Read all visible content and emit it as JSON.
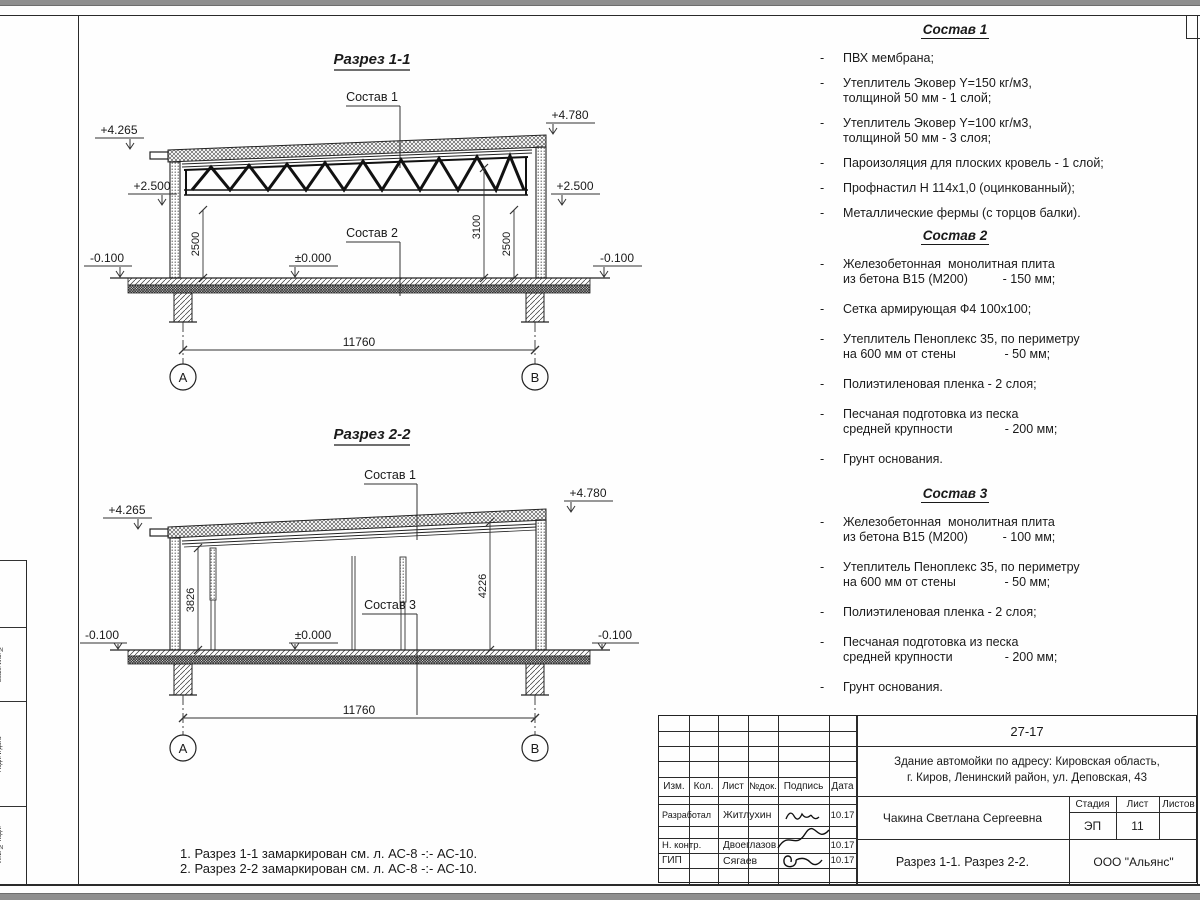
{
  "misc": {
    "dash": "-"
  },
  "s1": {
    "title": "Разрез 1-1",
    "lbl_sostav1": "Состав 1",
    "lbl_sostav2": "Состав 2",
    "elev_tl": "+4.265",
    "elev_tr": "+4.780",
    "elev_ml": "+2.500",
    "elev_mr": "+2.500",
    "elev_zero": "±0.000",
    "elev_gl": "-0.100",
    "elev_gr": "-0.100",
    "dim_left": "2500",
    "dim_mid": "3100",
    "dim_right": "2500",
    "dim_span": "11760",
    "axis_a": "А",
    "axis_b": "В"
  },
  "s2": {
    "title": "Разрез 2-2",
    "lbl_sostav1": "Состав 1",
    "lbl_sostav3": "Состав 3",
    "elev_tl": "+4.265",
    "elev_tr": "+4.780",
    "elev_zero": "±0.000",
    "elev_gl": "-0.100",
    "elev_gr": "-0.100",
    "dim_left": "3826",
    "dim_right": "4226",
    "dim_span": "11760",
    "axis_a": "А",
    "axis_b": "В"
  },
  "compositions": [
    {
      "heading": "Состав 1",
      "items": [
        {
          "lines": [
            "ПВХ мембрана;"
          ]
        },
        {
          "lines": [
            "Утеплитель Эковер Y=150 кг/м3,",
            "толщиной 50 мм - 1 слой;"
          ]
        },
        {
          "lines": [
            "Утеплитель Эковер Y=100 кг/м3,",
            "толщиной 50 мм - 3 слоя;"
          ]
        },
        {
          "lines": [
            "Пароизоляция для плоских кровель - 1 слой;"
          ]
        },
        {
          "lines": [
            "Профнастил Н 114х1,0 (оцинкованный);"
          ]
        },
        {
          "lines": [
            "Металлические фермы (с торцов балки)."
          ]
        }
      ]
    },
    {
      "heading": "Состав 2",
      "items": [
        {
          "lines": [
            "Железобетонная  монолитная плита",
            "из бетона В15 (М200)          - 150 мм;"
          ]
        },
        {
          "lines": [
            "Сетка армирующая Ф4 100х100;"
          ]
        },
        {
          "lines": [
            "Утеплитель Пеноплекс 35, по периметру",
            "на 600 мм от стены              - 50 мм;"
          ]
        },
        {
          "lines": [
            "Полиэтиленовая пленка - 2 слоя;"
          ]
        },
        {
          "lines": [
            "Песчаная подготовка из песка",
            "средней крупности               - 200 мм;"
          ]
        },
        {
          "lines": [
            "Грунт основания."
          ]
        }
      ]
    },
    {
      "heading": "Состав 3",
      "items": [
        {
          "lines": [
            "Железобетонная  монолитная плита",
            "из бетона В15 (М200)          - 100 мм;"
          ]
        },
        {
          "lines": [
            "Утеплитель Пеноплекс 35, по периметру",
            "на 600 мм от стены              - 50 мм;"
          ]
        },
        {
          "lines": [
            "Полиэтиленовая пленка - 2 слоя;"
          ]
        },
        {
          "lines": [
            "Песчаная подготовка из песка",
            "средней крупности               - 200 мм;"
          ]
        },
        {
          "lines": [
            "Грунт основания."
          ]
        }
      ]
    }
  ],
  "notes": {
    "line1": "1. Разрез 1-1 замаркирован см. л. АС-8 -:- АС-10.",
    "line2": "2. Разрез 2-2 замаркирован см. л. АС-8 -:- АС-10."
  },
  "title_block": {
    "project_code": "27-17",
    "project_name_line1": "Здание автомойки по адресу: Кировская область,",
    "project_name_line2": "г. Киров, Ленинский район, ул. Деповская, 43",
    "col_izm": "Изм.",
    "col_kol": "Кол.",
    "col_list": "Лист",
    "col_ndok": "№док.",
    "col_podpis": "Подпись",
    "col_data": "Дата",
    "row1_role": "Разработал",
    "row1_name": "Житлухин",
    "row1_date": "10.17",
    "row2_role": "Н. контр.",
    "row2_name": "Двоеглазов",
    "row2_date": "10.17",
    "row3_role": "ГИП",
    "row3_name": "Сягаев",
    "row3_date": "10.17",
    "author": "Чакина Светлана Сергеевна",
    "stage_label": "Стадия",
    "sheet_label": "Лист",
    "sheets_label": "Листов",
    "stage_value": "ЭП",
    "sheet_value": "11",
    "sheets_value": "",
    "drawing_name": "Разрез 1-1. Разрез 2-2.",
    "company": "ООО \"Альянс\""
  },
  "side_strip": {
    "labels": [
      "Взам. инв. №",
      "Подп. и дата",
      "Инв. № подл."
    ]
  }
}
